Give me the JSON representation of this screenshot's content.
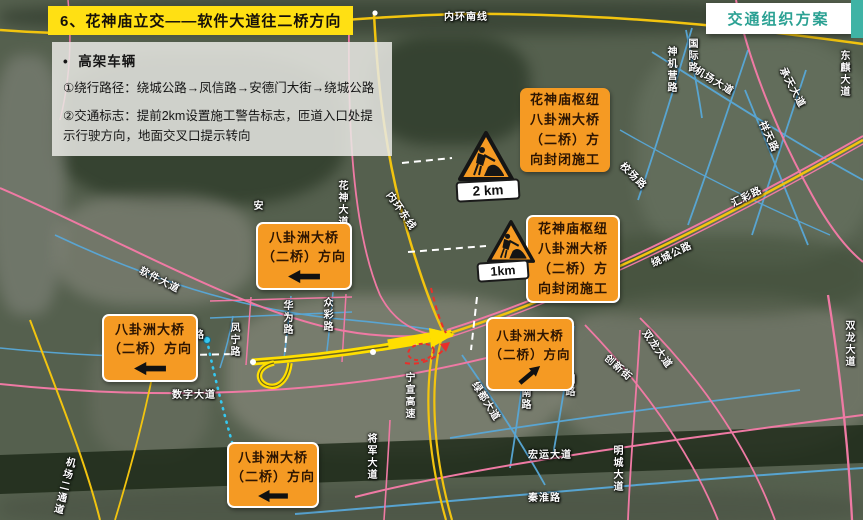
{
  "header": {
    "title": "6、花神庙立交——软件大道往二桥方向",
    "badge": "交通组织方案"
  },
  "info_panel": {
    "bullet": "•",
    "heading": "高架车辆",
    "item1": "①绕行路径：绕城公路→凤信路→安德门大街→绕城公路",
    "item2": "②交通标志：提前2km设置施工警告标志，匝道入口处提示行驶方向，地面交叉口提示转向"
  },
  "closure_signs": {
    "line1": "花神庙枢纽",
    "line2": "八卦洲大桥",
    "line3": "（二桥）方",
    "line4": "向封闭施工"
  },
  "direction_signs": {
    "line1": "八卦洲大桥",
    "line2": "（二桥）方向"
  },
  "construction_markers": {
    "marker1_distance": "2 km",
    "marker2_distance": "1km"
  },
  "icons": {
    "left_arrow": "⬅",
    "up_right_arrow": "⬈",
    "construction_worker": "🚧"
  },
  "colors": {
    "sign_orange": "#F59A23",
    "badge_teal": "#2BA193",
    "title_highlight_yellow": "#FFE013",
    "route_highlight_yellow": "#FFDF00",
    "road_pink": "#EF7AA4",
    "road_blue": "#58A8D8",
    "road_yellow": "#F2C40F",
    "alert_red": "#E8302A"
  },
  "map": {
    "road_labels": [
      {
        "text": "内环南线"
      },
      {
        "text": "神机营路"
      },
      {
        "text": "国际路"
      },
      {
        "text": "机场大道"
      },
      {
        "text": "承天大道"
      },
      {
        "text": "东麒大道"
      },
      {
        "text": "祥天路"
      },
      {
        "text": "校场路"
      },
      {
        "text": "绕城公路"
      },
      {
        "text": "汇彩路"
      },
      {
        "text": "双龙大道"
      },
      {
        "text": "双龙大道"
      },
      {
        "text": "花神大道"
      },
      {
        "text": "内环东线"
      },
      {
        "text": "安"
      },
      {
        "text": "软件大道"
      },
      {
        "text": "双路"
      },
      {
        "text": "凤宁路"
      },
      {
        "text": "华为路"
      },
      {
        "text": "众彩路"
      },
      {
        "text": "宁宣高速"
      },
      {
        "text": "绿都大道"
      },
      {
        "text": "江南路"
      },
      {
        "text": "明路"
      },
      {
        "text": "创新街"
      },
      {
        "text": "明城大道"
      },
      {
        "text": "宏运大道"
      },
      {
        "text": "秦淮路"
      },
      {
        "text": "将军大道"
      },
      {
        "text": "数字大道"
      },
      {
        "text": "机场二通道"
      }
    ]
  }
}
